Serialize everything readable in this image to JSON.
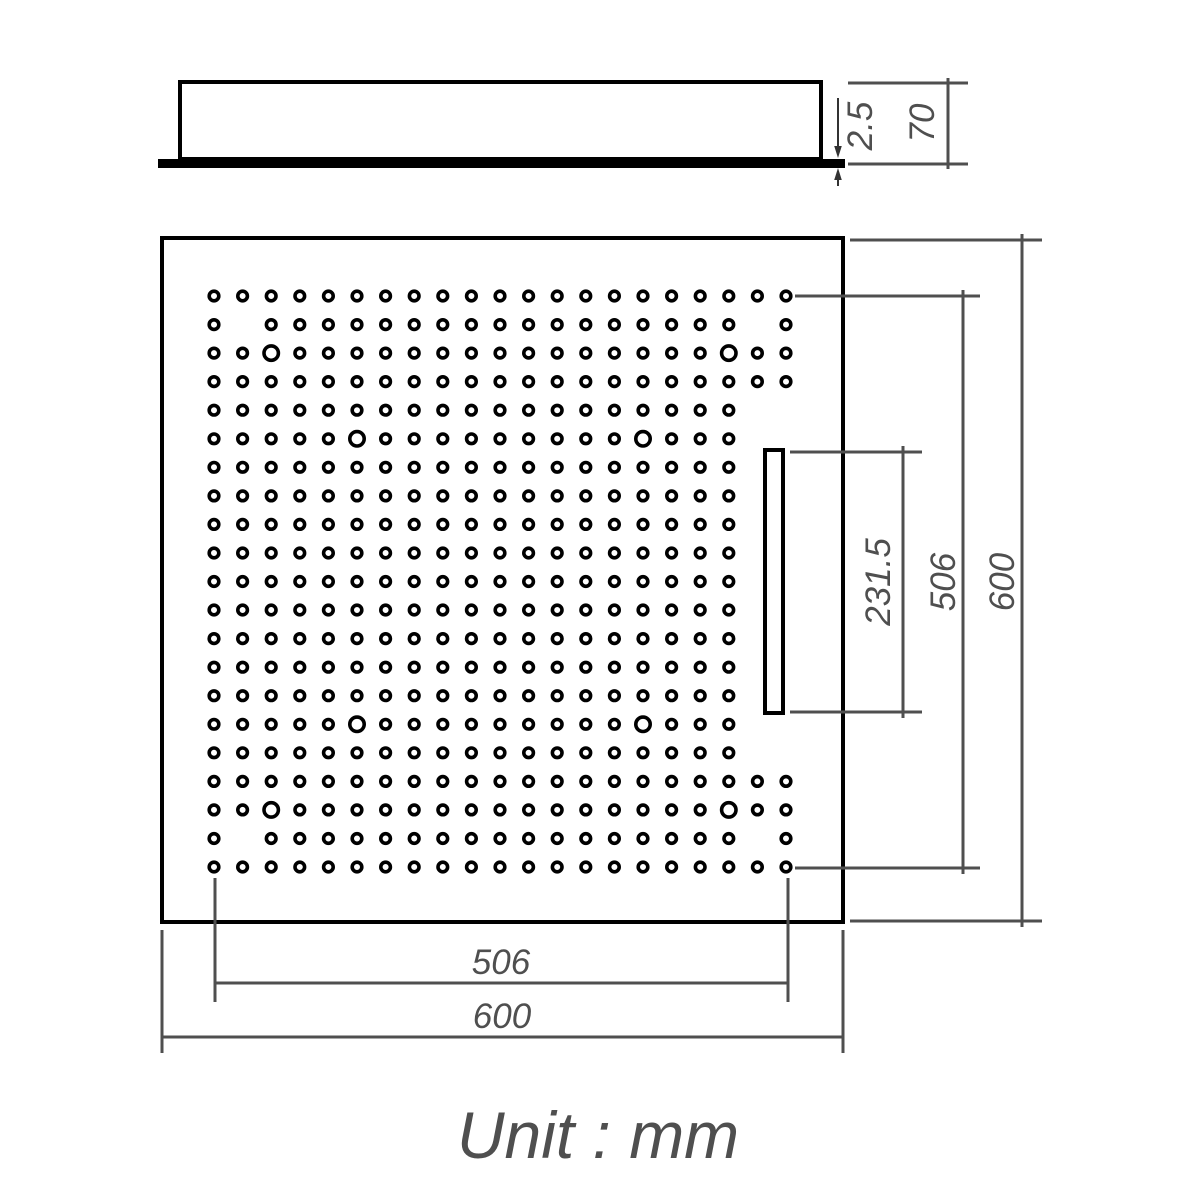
{
  "document": {
    "type": "technical-dimension-drawing",
    "subject": "square perforated shower head panel"
  },
  "unit_note": "Unit : mm",
  "colors": {
    "outline": "#000000",
    "dimension": "#4f4f4f",
    "background": "#ffffff"
  },
  "side_view": {
    "plate_thickness_label": "2.5",
    "total_height_label": "70"
  },
  "front_view": {
    "overall_width_label": "600",
    "overall_height_label": "600",
    "hole_field_width_label": "506",
    "hole_field_height_label": "506",
    "slot_length_label": "231.5"
  },
  "hole_grid": {
    "rows": 21,
    "cols": 21,
    "missing_holes": [
      [
        2,
        2
      ],
      [
        2,
        20
      ],
      [
        20,
        2
      ],
      [
        20,
        20
      ]
    ],
    "slot_clear": {
      "row_start": 5,
      "row_end": 17,
      "cols": [
        20,
        21
      ]
    },
    "large_holes": [
      [
        3,
        3
      ],
      [
        3,
        19
      ],
      [
        6,
        6
      ],
      [
        6,
        16
      ],
      [
        16,
        6
      ],
      [
        16,
        16
      ],
      [
        19,
        3
      ],
      [
        19,
        19
      ]
    ]
  }
}
